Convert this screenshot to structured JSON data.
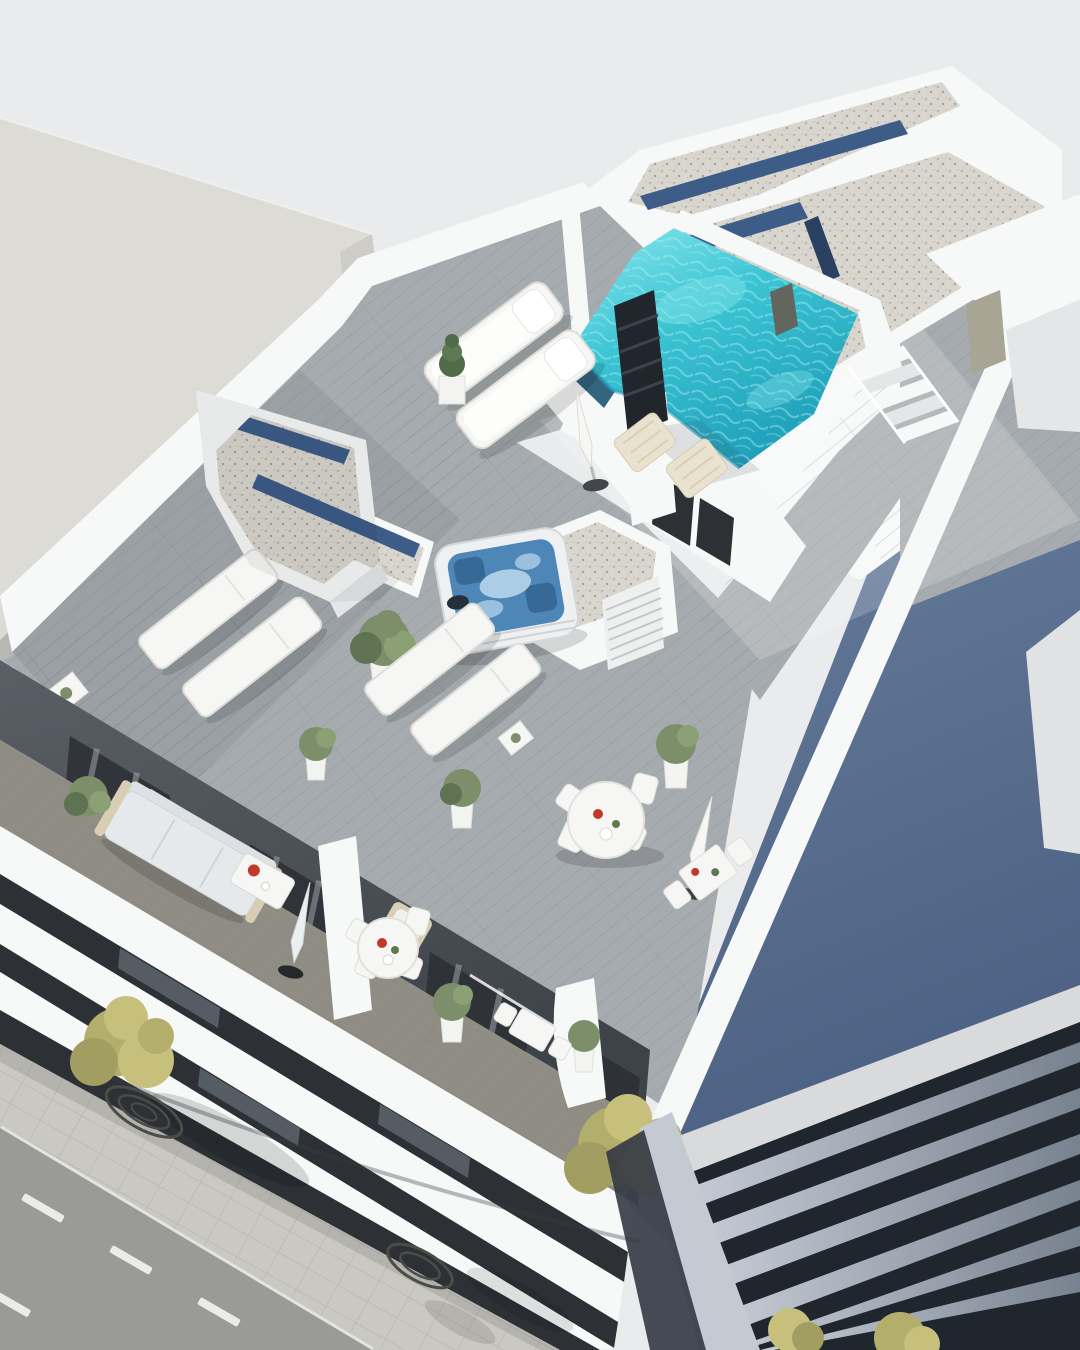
{
  "scene": {
    "type": "3d-architectural-aerial-render",
    "description": "Aerial 3D visualization of a white apartment building: rooftop terraces with turquoise pool, jacuzzi, sun loungers, gravel roofs with skylights, furnished balconies, street with trees below and a dark-louvered neighbouring building at right",
    "width": 1080,
    "height": 1350
  },
  "colors": {
    "sky": "#e9ebec",
    "neighborRoof": "#dcdbd6",
    "neighborFace": "#cdccc7",
    "alleyShade": "#b7b8b4",
    "wallWhite": "#f7f8f8",
    "wallShade": "#e4e6e8",
    "wallDark": "#c9ced4",
    "deckBase": "#a6abaf",
    "deckPlank": "#878e94",
    "balconyDeck": "#908d85",
    "balconyWallTop": "#5a5f66",
    "balconyWallBot": "#3e4349",
    "glass": "#2d3136",
    "windowSliver": "#565c64",
    "curtain": "#a9aeb4",
    "gravel": "#d9d6cf",
    "speckA": "#bdb7ac",
    "speckB": "#a8a298",
    "speckC": "#cfc9be",
    "skylight": "#3d5c88",
    "skylightDark": "#2b4161",
    "poolLight": "#8ae8ee",
    "poolWater": "#3cc4d3",
    "poolDeep": "#1f9fba",
    "poolEdge": "#33657f",
    "rippleLight": "#aef0f2",
    "jacuzzi": "#4e86b8",
    "jacuzziFoam": "#bcd9ec",
    "jacuzziSeat": "#2b5984",
    "chimney": "#20262c",
    "chimneyFin": "#3b434d",
    "doorBeige": "#a8a594",
    "doorDark": "#63665c",
    "shadowWallTop": "#6a7f9d",
    "shadowWallBot": "#4d6284",
    "louverBase": "#20262e",
    "louverSlatA": "#c7cdd6",
    "louverSlatB": "#77828f",
    "louverFascia": "#d8dadb",
    "gapWall": "#c3cad2",
    "gapShadow": "#333944",
    "road": "#9a9b97",
    "roadMark": "#ebebe7",
    "sidewalk": "#c9c8c2",
    "paver": "#b1b0aa",
    "curb": "#e3e3df",
    "grate": "#4b4b47",
    "treeYellowA": "#b4ae6d",
    "treeYellowB": "#c6c07c",
    "treeYellowC": "#a29d60",
    "treeGreenA": "#7d8f6a",
    "treeGreenB": "#5f7352",
    "treeGreenC": "#8ba075",
    "pot": "#f3f4f2",
    "furniture": "#f6f6f4",
    "furnitureStroke": "#dddeda",
    "cushion": "#fdfdfb",
    "woodTan": "#d9cdb4",
    "woodChair": "#e9e2cf",
    "sofa": "#e6e9eb",
    "sofaBack": "#dde1e4",
    "red": "#c0392b",
    "greenDot": "#5d7a4e",
    "shadow": "#000000"
  },
  "objects": {
    "pool": "rooftop swimming pool",
    "jacuzzi": "hot tub",
    "gravelRoof": "gravel roof with skylight strips",
    "deck": "wooden roof terrace deck",
    "loungers": "sun loungers",
    "diningSet": "outdoor dining table set",
    "sofa": "balcony sofa",
    "street": "street with trees and sidewalk",
    "louverBuilding": "neighbouring building with dark louvers"
  }
}
